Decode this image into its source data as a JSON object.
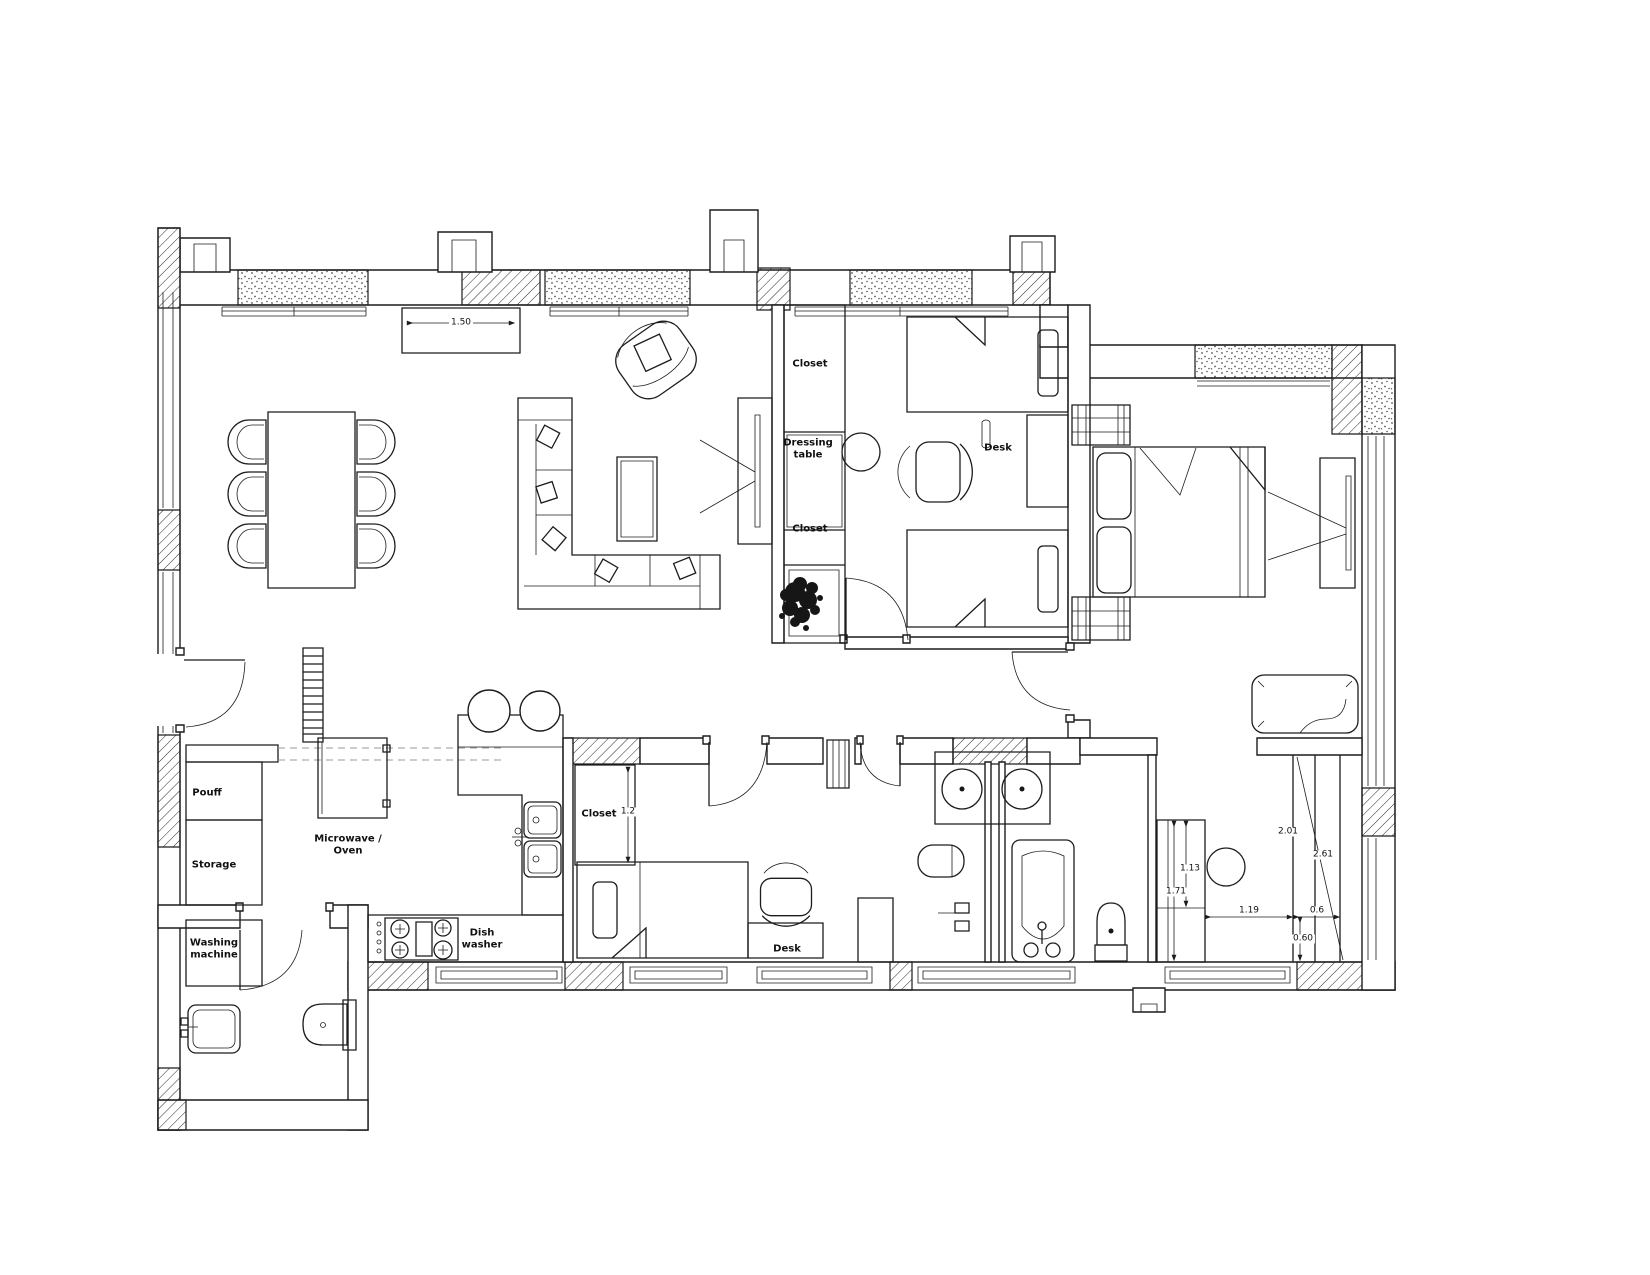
{
  "drawing": {
    "kind": "apartment floor plan",
    "colors": {
      "background": "#ffffff",
      "line": "#1c1c1c",
      "centerline": "#8a8a8a",
      "foliage": "#161616"
    }
  },
  "room_labels": {
    "closet_kids_top": "Closet",
    "dressing_table": "Dressing table",
    "closet_kids_bottom": "Closet",
    "desk_kids": "Desk",
    "closet_bedroom2": "Closet",
    "desk_bedroom2": "Desk",
    "pouff": "Pouff",
    "storage": "Storage",
    "washing_machine": "Washing machine",
    "microwave_oven": "Microwave / Oven",
    "dish_washer": "Dish washer"
  },
  "dimensions": {
    "tv_unit": "1.50",
    "closet_b2": "1.2",
    "wic_113": "1.13",
    "wic_171": "1.71",
    "wic_119": "1.19",
    "wic_06": "0.6",
    "wic_060": "0.60",
    "wic_201": "2.01",
    "wic_261": "2.61"
  },
  "symbols": [
    "dining-table-with-six-chairs",
    "l-shaped-sofa",
    "coffee-table",
    "armchair",
    "tv-panel",
    "tv-unit",
    "double-bed",
    "single-bed",
    "single-bed",
    "bed",
    "desk",
    "desk-chair",
    "dressing-table",
    "round-stool",
    "walk-in-wardrobe",
    "plant",
    "kitchen-peninsula",
    "bar-stools",
    "kitchen-sink",
    "hob",
    "tall-oven-cabinet",
    "double-sink-vanity",
    "bathtub",
    "toilet",
    "wall-hung-toilet",
    "washing-machine",
    "laundry-sink",
    "radiator",
    "entry-door",
    "interior-doors",
    "windows",
    "hatched-structural-walls",
    "insulated-wall-fill"
  ]
}
